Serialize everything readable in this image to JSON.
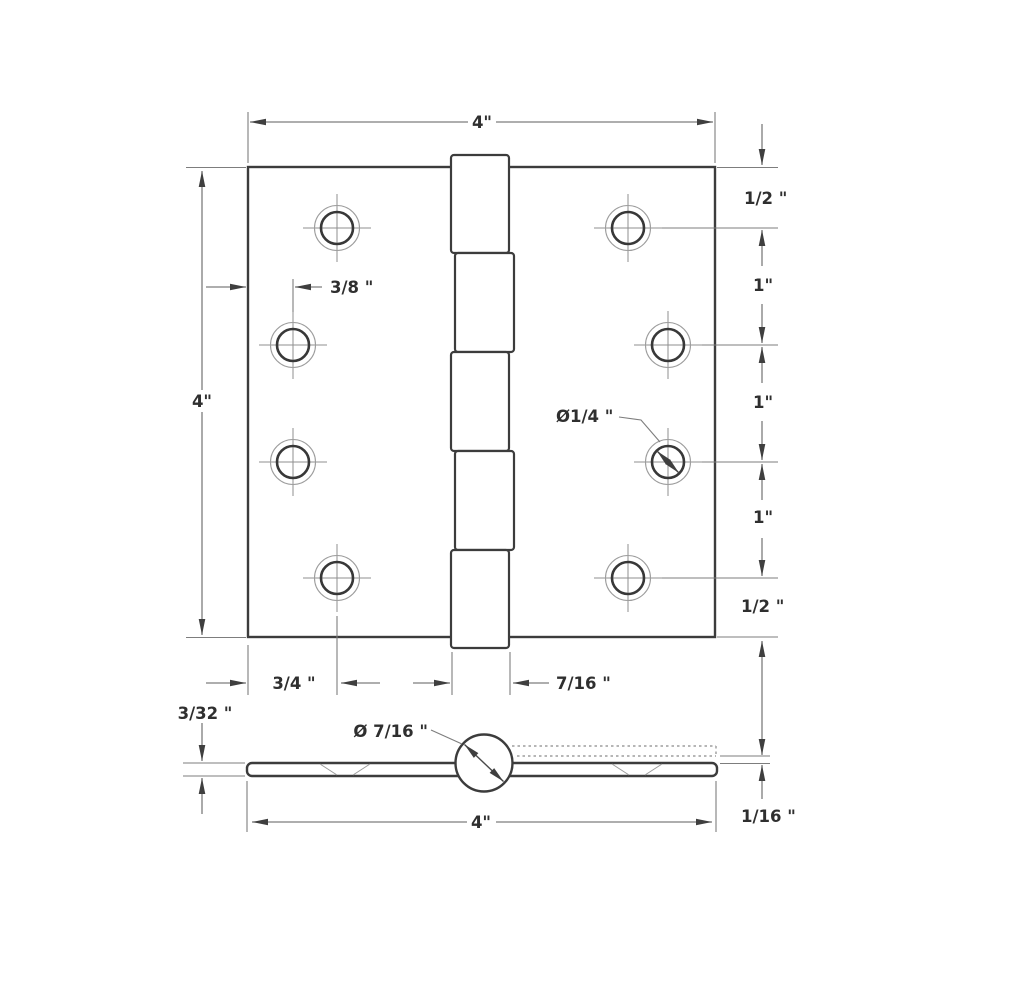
{
  "drawing": {
    "top_view": {
      "width": "4\"",
      "height": "4\"",
      "hole_offset": "3/8 \"",
      "hole_diameter": "Ø1/4 \"",
      "row_spacings": [
        "1/2 \"",
        "1\"",
        "1\"",
        "1\"",
        "1/2 \""
      ],
      "edge_to_hole": "3/4 \"",
      "knuckle_width": "7/16 \""
    },
    "side_view": {
      "thickness": "3/32 \"",
      "barrel_diameter": "Ø 7/16 \"",
      "width": "4\"",
      "leaf_gap": "1/16 \""
    },
    "colors": {
      "outline": "#3c3c3c",
      "dimension": "#7d7d7d",
      "centerline": "#8f8f8f",
      "text": "#2f2f2f",
      "background": "#ffffff"
    }
  }
}
